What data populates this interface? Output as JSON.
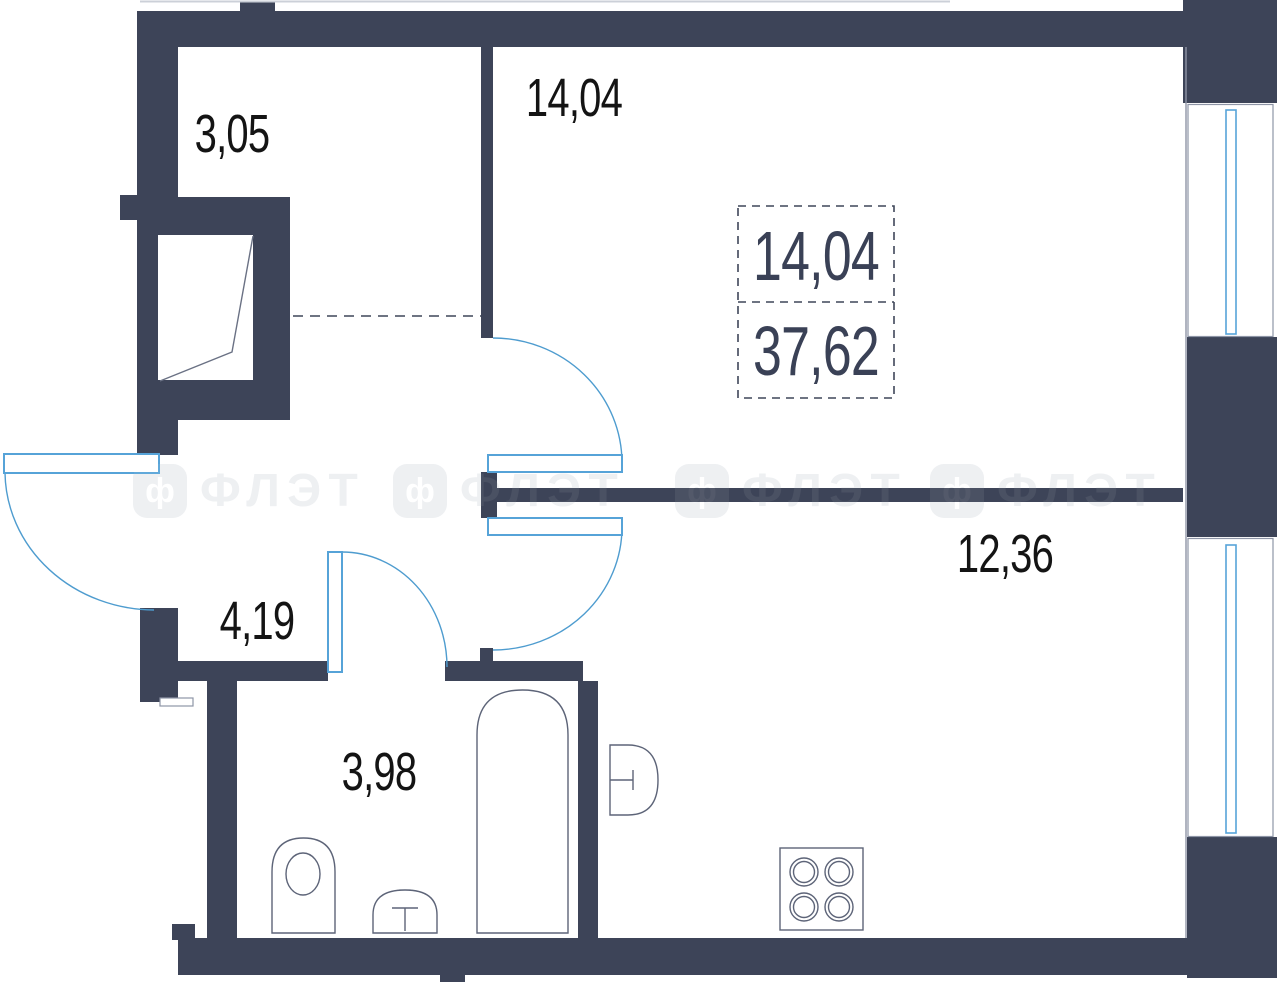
{
  "plan": {
    "title": "apartment floor plan",
    "rooms": [
      {
        "name": "hallway-top",
        "area": "3,05"
      },
      {
        "name": "living-room",
        "area": "14,04"
      },
      {
        "name": "corridor",
        "area": "4,19"
      },
      {
        "name": "bathroom",
        "area": "3,98"
      },
      {
        "name": "kitchen-living",
        "area": "12,36"
      }
    ],
    "summary": {
      "living": "14,04",
      "total": "37,62"
    },
    "watermark": {
      "text": "ФЛЭТ",
      "glyph": "ф"
    },
    "colors": {
      "wall": "#3d4458",
      "door": "#56a3d8",
      "fixture": "#5d6478",
      "label": "#141414",
      "summary_text": "#3a4156",
      "watermark": "#edeff2"
    }
  }
}
